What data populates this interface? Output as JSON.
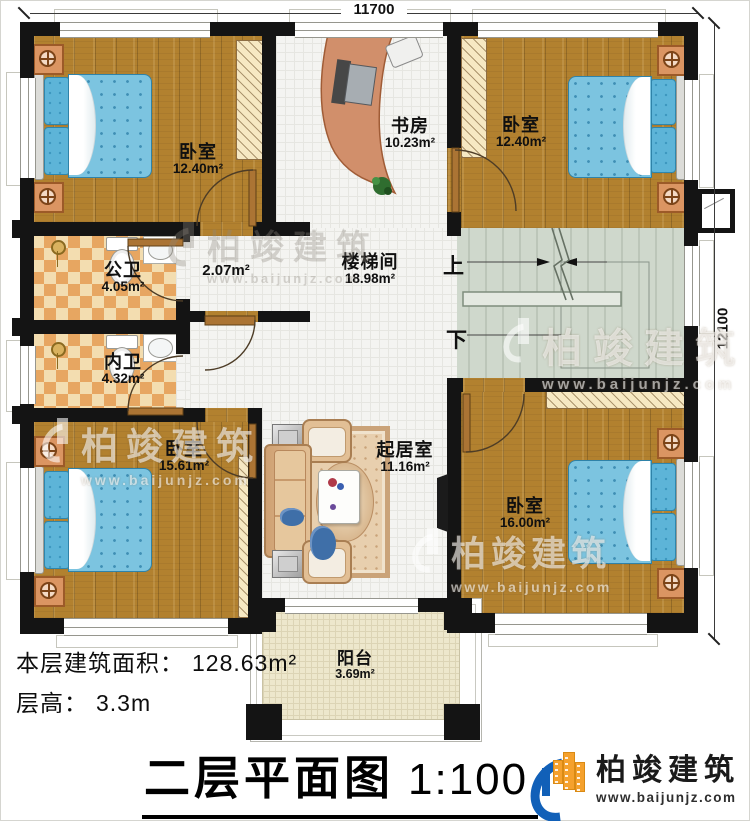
{
  "dimensions": {
    "top": "11700",
    "right": "12100"
  },
  "rooms": {
    "bedroom_tl": {
      "name": "卧室",
      "area": "12.40m²"
    },
    "study": {
      "name": "书房",
      "area": "10.23m²"
    },
    "bedroom_tr": {
      "name": "卧室",
      "area": "12.40m²"
    },
    "bath_public": {
      "name": "公卫",
      "area": "4.05m²"
    },
    "corridor": {
      "area": "2.07m²"
    },
    "bath_private": {
      "name": "内卫",
      "area": "4.32m²"
    },
    "stairwell": {
      "name": "楼梯间",
      "area": "18.98m²"
    },
    "bedroom_bl": {
      "name": "卧室",
      "area": "15.61m²"
    },
    "living_room": {
      "name": "起居室",
      "area": "11.16m²"
    },
    "bedroom_br": {
      "name": "卧室",
      "area": "16.00m²"
    },
    "balcony": {
      "name": "阳台",
      "area": "3.69m²"
    }
  },
  "stairs": {
    "up": "上",
    "down": "下"
  },
  "footer": {
    "area_label": "本层建筑面积：",
    "area_value": "128.63m²",
    "height_label": "层高：",
    "height_value": "3.3m",
    "title": "二层平面图",
    "scale": "1:100"
  },
  "brand": {
    "name": "柏竣建筑",
    "site": "www.baijunjz.com"
  },
  "watermark": {
    "name": "柏竣建筑",
    "site": "www.baijunjz.com"
  },
  "colors": {
    "wall": "#141414",
    "wood_floor": "#b2812f",
    "bed": "#7cc4e0",
    "bath_tile": "#e7a661",
    "stair_floor": "#cfd8cc",
    "brand_blue": "#1160b8",
    "brand_orange": "#f5a12d"
  }
}
